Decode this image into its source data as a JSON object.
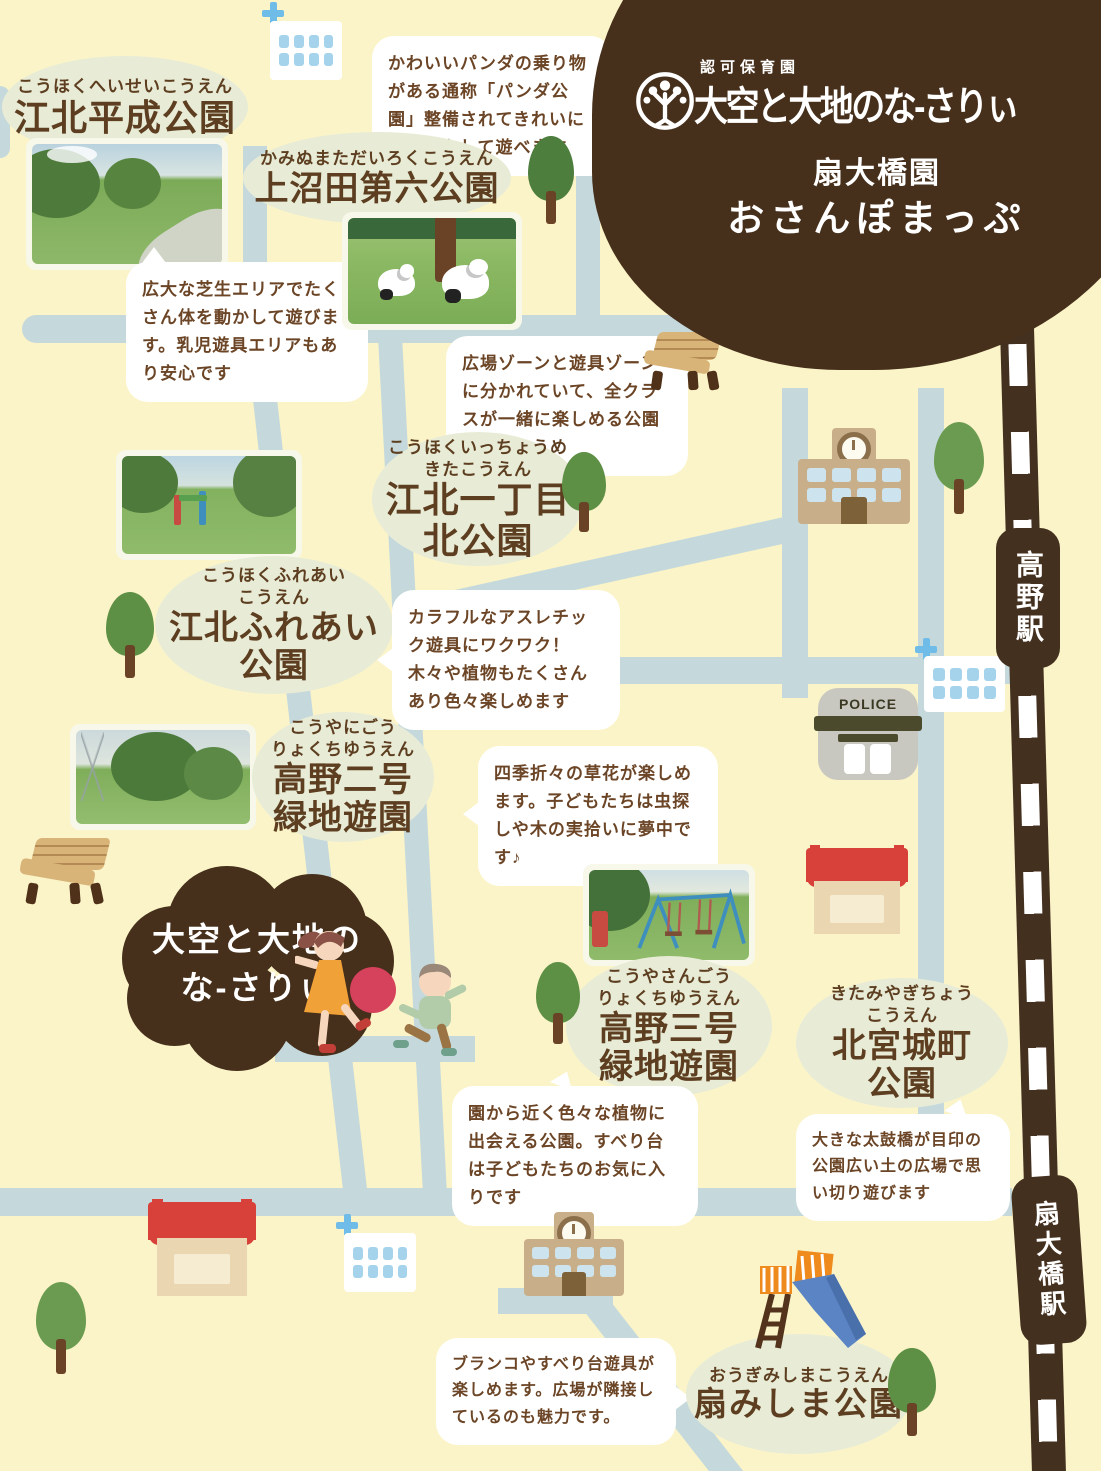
{
  "header": {
    "license": "認可保育園",
    "brand": "大空と大地のな-さりぃ",
    "branch": "扇大橋園",
    "title": "おさんぽまっぷ"
  },
  "nursery_marker": {
    "line1": "大空と大地の",
    "line2": "な-さりぃ"
  },
  "stations": [
    {
      "name": "高野駅"
    },
    {
      "name": "扇大橋駅"
    }
  ],
  "police_label": "POLICE",
  "parks": [
    {
      "id": "kohoku-heisei",
      "furigana": [
        "こうほくへいせいこうえん"
      ],
      "name": [
        "江北平成公園"
      ],
      "description": "広大な芝生エリアでたくさん体を動かして遊びます。乳児遊具エリアもあり安心です"
    },
    {
      "id": "kaminumata-dairoku",
      "furigana": [
        "かみぬまただいろくこうえん"
      ],
      "name": [
        "上沼田第六公園"
      ],
      "description": "かわいいパンダの乗り物がある通称「パンダ公園」整備されてきれいになり安心して遊べます"
    },
    {
      "id": "kohoku-itchome-kita",
      "furigana": [
        "こうほくいっちょうめ",
        "きたこうえん"
      ],
      "name": [
        "江北一丁目",
        "北公園"
      ],
      "description": "広場ゾーンと遊具ゾーンに分かれていて、全クラスが一緒に楽しめる公園です！"
    },
    {
      "id": "kohoku-fureai",
      "furigana": [
        "こうほくふれあい",
        "こうえん"
      ],
      "name": [
        "江北ふれあい",
        "公園"
      ],
      "description": "カラフルなアスレチック遊具にワクワク！木々や植物もたくさんあり色々楽しめます"
    },
    {
      "id": "koya-2-ryokuchi",
      "furigana": [
        "こうやにごう",
        "りょくちゆうえん"
      ],
      "name": [
        "高野二号",
        "緑地遊園"
      ],
      "description": "四季折々の草花が楽しめます。子どもたちは虫探しや木の実拾いに夢中です♪"
    },
    {
      "id": "koya-3-ryokuchi",
      "furigana": [
        "こうやさんごう",
        "りょくちゆうえん"
      ],
      "name": [
        "高野三号",
        "緑地遊園"
      ],
      "description": "園から近く色々な植物に出会える公園。すべり台は子どもたちのお気に入りです"
    },
    {
      "id": "kitamiyagi-cho",
      "furigana": [
        "きたみやぎちょう",
        "こうえん"
      ],
      "name": [
        "北宮城町",
        "公園"
      ],
      "description": "大きな太鼓橋が目印の公園広い土の広場で思い切り遊びます"
    },
    {
      "id": "ogi-mishima",
      "furigana": [
        "おうぎみしまこうえん"
      ],
      "name": [
        "扇みしま公園"
      ],
      "description": "ブランコやすべり台遊具が楽しめます。広場が隣接しているのも魅力です。"
    }
  ],
  "colors": {
    "background": "#fbf4c8",
    "road": "#c5d9dc",
    "railway_brown": "#44301f",
    "brand_brown": "#462f1b",
    "bubble_green": "#e8ecd6",
    "text_brown": "#5d3e20",
    "store_red": "#d8413a",
    "tree_green": "#5d8f45"
  }
}
